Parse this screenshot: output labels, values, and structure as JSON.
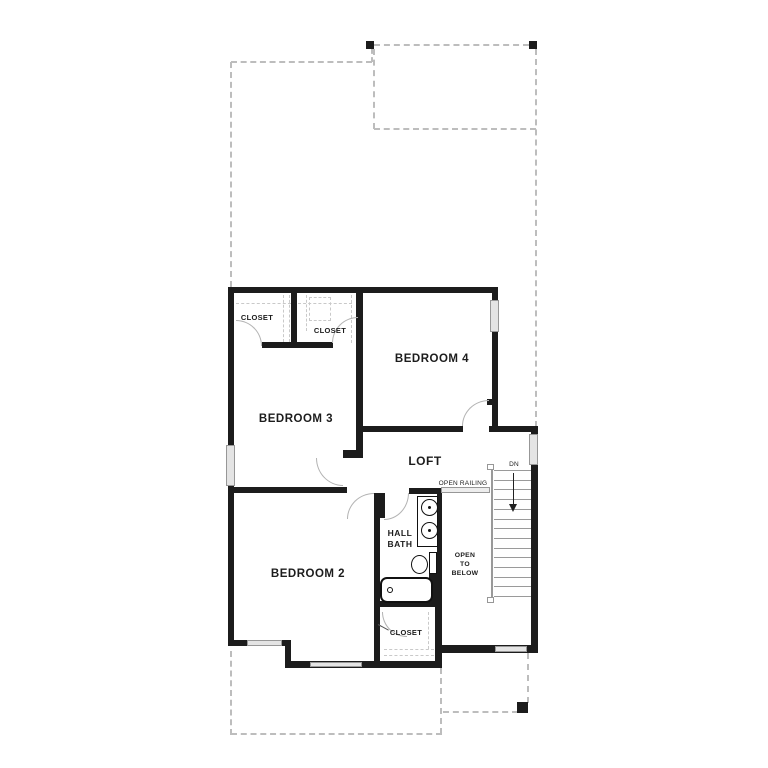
{
  "plan": {
    "labels": {
      "bedroom2": "BEDROOM 2",
      "bedroom3": "BEDROOM 3",
      "bedroom4": "BEDROOM 4",
      "loft": "LOFT",
      "hall_bath_line1": "HALL",
      "hall_bath_line2": "BATH",
      "closet_bedroom3": "CLOSET",
      "closet_bedroom4": "CLOSET",
      "closet_bedroom2": "CLOSET",
      "open_railing": "OPEN RAILING",
      "stairs_direction": "DN",
      "open_to_below_line1": "OPEN",
      "open_to_below_line2": "TO",
      "open_to_below_line3": "BELOW"
    },
    "colors": {
      "wall": "#1c1c1c",
      "dashed_outline": "#bdbdbd",
      "window_fill": "#e4e4e4",
      "window_border": "#979797",
      "stair": "#9a9a9a",
      "text": "#1c1c1c",
      "background": "#ffffff"
    }
  }
}
